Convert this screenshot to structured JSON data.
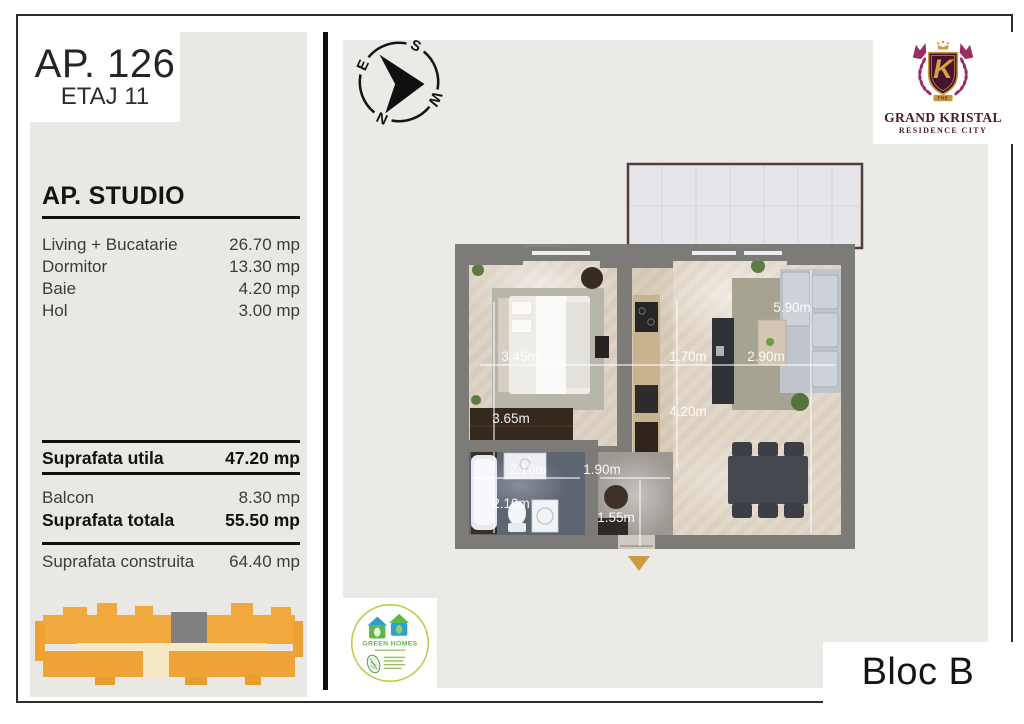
{
  "left_panel": {
    "apartment": "AP. 126",
    "floor": "ETAJ 11",
    "title": "AP. STUDIO",
    "rooms": [
      {
        "label": "Living + Bucatarie",
        "value": "26.70 mp"
      },
      {
        "label": "Dormitor",
        "value": "13.30 mp"
      },
      {
        "label": "Baie",
        "value": "4.20 mp"
      },
      {
        "label": "Hol",
        "value": "3.00 mp"
      }
    ],
    "summary": {
      "utila": {
        "label": "Suprafata utila",
        "value": "47.20 mp"
      },
      "balcon": {
        "label": "Balcon",
        "value": "8.30 mp"
      },
      "totala": {
        "label": "Suprafata totala",
        "value": "55.50 mp"
      },
      "construita": {
        "label": "Suprafata construita",
        "value": "64.40 mp"
      }
    }
  },
  "brand": {
    "the": "THE",
    "name": "GRAND KRISTAL",
    "subtitle": "RESIDENCE CITY"
  },
  "compass": {
    "n": "N",
    "e": "E",
    "s": "S",
    "w": "W"
  },
  "plan": {
    "dims": {
      "bedroom_w": "3.45m",
      "bedroom_h": "3.65m",
      "kitchen_w": "1.70m",
      "living_w": "2.90m",
      "living_h": "5.90m",
      "mid_h": "4.20m",
      "bath_w": "2.10m",
      "bath_h": "2.10m",
      "hall_w": "1.90m",
      "hall_h": "1.55m"
    }
  },
  "footer": {
    "block": "Bloc B",
    "eco_title": "GREEN HOMES"
  },
  "colors": {
    "wall_gray": "#7c7b77",
    "building_orange": "#f1a83d",
    "building_cream": "#f8e9c6",
    "unit_gray": "#818181",
    "brand_magenta": "#9b2d66",
    "brand_maroon": "#471430",
    "brand_gold": "#cf9b3e",
    "eco_green": "#5cb848",
    "eco_blue": "#2e9fd0",
    "entrance_arrow": "#cf9b3e"
  }
}
